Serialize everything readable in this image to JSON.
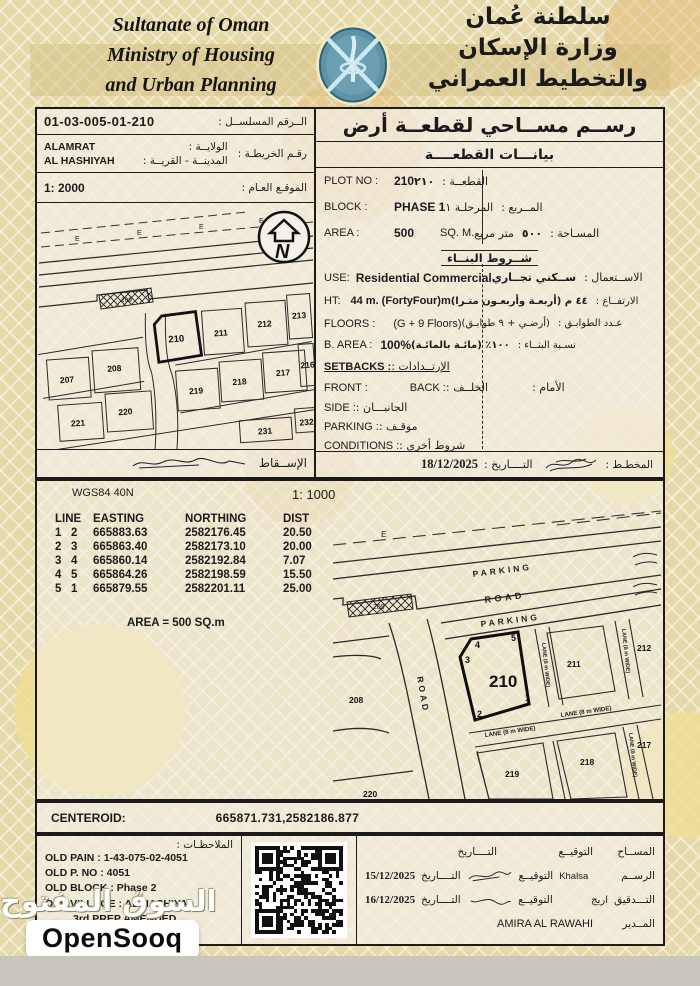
{
  "colors": {
    "paper": "#e6d9a9",
    "ink": "#1b1b1b",
    "emblem_blue": "#5e93a7",
    "band": "#d4c084"
  },
  "header": {
    "en": [
      "Sultanate of Oman",
      "Ministry of Housing",
      "and Urban Planning"
    ],
    "ar": [
      "سلطنة عُمان",
      "وزارة الإسكان",
      "والتخطيط العمراني"
    ]
  },
  "top_left": {
    "serial_label": "الــرقم المسلســل :",
    "serial_value": "01-03-005-01-210",
    "map_no_label": "رقـم الخريطـة :",
    "wilaya_label": "الولايــة :",
    "wilaya_value": "ALAMRAT",
    "city_label": "المدينــة - القريــة :",
    "city_value": "AL HASHIYAH",
    "location_label": "الموقـع العـام :",
    "location_scale": "1: 2000",
    "projection_label": "الإســقاط"
  },
  "plot_box": {
    "title": "رســم مســاحي لقطعــة أرض",
    "subtitle": "بيانـــات القطعــــة",
    "rows": [
      {
        "en_label": "PLOT NO :",
        "en_value": "210",
        "ar_value": "٢١٠",
        "ar_label": "القطعــة :"
      },
      {
        "en_label": "BLOCK :",
        "en_value": "PHASE 1",
        "ar_value": "المرحلـة ١",
        "ar_label": "المــربع :"
      },
      {
        "en_label": "AREA :",
        "en_value": "500",
        "en_unit": "SQ. M.",
        "ar_value": "٥٠٠",
        "ar_unit": "متر مربع",
        "ar_label": "المسـاحة :"
      }
    ]
  },
  "building": {
    "header": "شــروط البنــاء",
    "rows": [
      {
        "en_label": "USE:",
        "en_value": "Residential Commercial",
        "ar_value": "ســكني تجــاري",
        "ar_label": "الاســتعمال :"
      },
      {
        "en_label": "HT:",
        "en_value": "44 m.  (FortyFour)m",
        "ar_value": "٤٤ م  (أربعـة وأربعـون متـرا)",
        "ar_label": "الارتفــاع :"
      },
      {
        "en_label": "FLOORS :",
        "en_value": "(G + 9 Floors)",
        "ar_value": "(أرضـي + ٩ طوابـق)",
        "ar_label": "عـدد الطوابـق :"
      },
      {
        "en_label": "B. AREA :",
        "en_value": "100%",
        "ar_value": "١٠٠٪  (مائـة بالمائـة)",
        "ar_label": "نسـبة البنــاء :"
      }
    ],
    "setbacks_en": "SETBACKS :",
    "setbacks_ar": "الإرتــدادات :",
    "front_en": "FRONT :",
    "back_en": "BACK :",
    "back_ar": "الخلــف :",
    "front_ar": "الأمام :",
    "side_en": "SIDE :",
    "side_ar": "الجانبـــان :",
    "parking_en": "PARKING :",
    "parking_ar": "موقـف :",
    "conditions_en": "CONDITIONS :",
    "conditions_ar": "شروط أخرى :",
    "date_label": "التــــاريخ :",
    "date_value": "18/12/2025",
    "planner_label": "المخطـط :"
  },
  "survey": {
    "datum": "WGS84 40N",
    "scale": "1: 1000",
    "headers": {
      "line": "LINE",
      "easting": "EASTING",
      "northing": "NORTHING",
      "dist": "DIST"
    },
    "rows": [
      [
        "1",
        "2",
        "665883.63",
        "2582176.45",
        "20.50"
      ],
      [
        "2",
        "3",
        "665863.40",
        "2582173.10",
        "20.00"
      ],
      [
        "3",
        "4",
        "665860.14",
        "2582192.84",
        "7.07"
      ],
      [
        "4",
        "5",
        "665864.26",
        "2582198.59",
        "15.50"
      ],
      [
        "5",
        "1",
        "665879.55",
        "2582201.11",
        "25.00"
      ]
    ],
    "area_line": "AREA = 500  SQ.m"
  },
  "maps": {
    "north": "N",
    "e_label": "E",
    "parking": "PARKING",
    "road": "ROAD",
    "lane": "LANE (8 m WIDE)",
    "hatch_plot": "209",
    "main_plot": "210",
    "corners": [
      "1",
      "2",
      "3",
      "4",
      "5"
    ],
    "plots": {
      "n207": "207",
      "n208": "208",
      "n210": "210",
      "n211": "211",
      "n212": "212",
      "n213": "213",
      "n216": "216",
      "n217": "217",
      "n218": "218",
      "n219": "219",
      "n220": "220",
      "n221": "221",
      "n231": "231",
      "n232": "232"
    }
  },
  "centeroid": {
    "label": "CENTEROID:",
    "value": "665871.731,2582186.877"
  },
  "notes": {
    "heading": "الملاحظـات :",
    "lines": [
      "OLD PAIN : 1-43-075-02-4051",
      "OLD P. NO : 4051",
      "OLD BLOCK : Phase 2",
      "OLD VILLAGE : AL HASHIYA"
    ],
    "stamp": "3rd PREP AMENDED"
  },
  "signatures": {
    "sig_label": "التوقيــع",
    "date_label": "التــــاريخ",
    "rows": [
      {
        "role": "المســاح",
        "name": "",
        "date": ""
      },
      {
        "role": "الرســم",
        "name": "Khalsa",
        "date": "15/12/2025"
      },
      {
        "role": "التـــدقيق",
        "name": "اريج",
        "date": "16/12/2025"
      },
      {
        "role": "المــدير",
        "name": "AMIRA AL RAWAHI",
        "date": ""
      }
    ]
  },
  "watermark": {
    "ar": "السوق المفتوح",
    "latin": "OpenSooq"
  }
}
